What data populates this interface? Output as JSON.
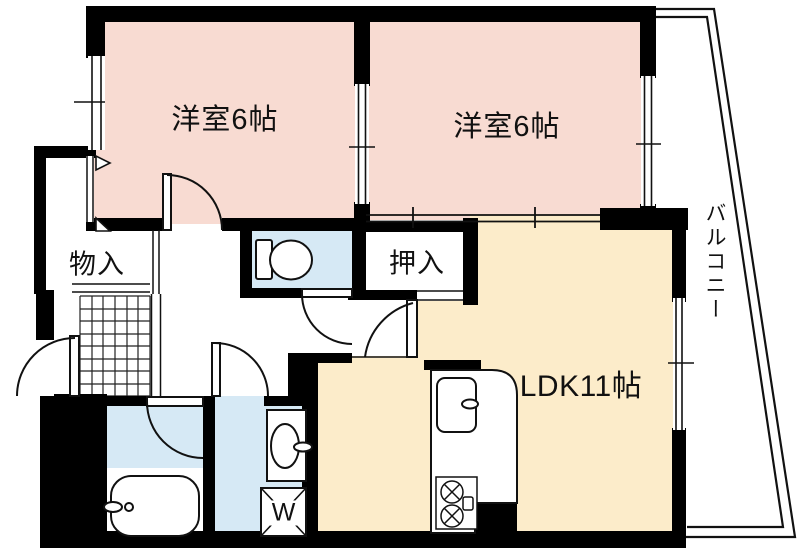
{
  "floorplan": {
    "labels": {
      "bedroom1": "洋室6帖",
      "bedroom2": "洋室6帖",
      "ldk": "LDK11帖",
      "closet": "押入",
      "storage": "物入",
      "balcony": "バルコニー",
      "washer": "W"
    },
    "colors": {
      "wall": "#000000",
      "bedroom_fill": "#f8dbd2",
      "ldk_fill": "#fcecca",
      "wet_area_fill": "#d6e9f5",
      "background": "#ffffff"
    },
    "fixtures": [
      "toilet-icon",
      "bathtub-icon",
      "vanity-sink-icon",
      "washing-machine-icon",
      "kitchen-sink-icon",
      "gas-stove-icon",
      "entrance-tile-grid"
    ]
  }
}
